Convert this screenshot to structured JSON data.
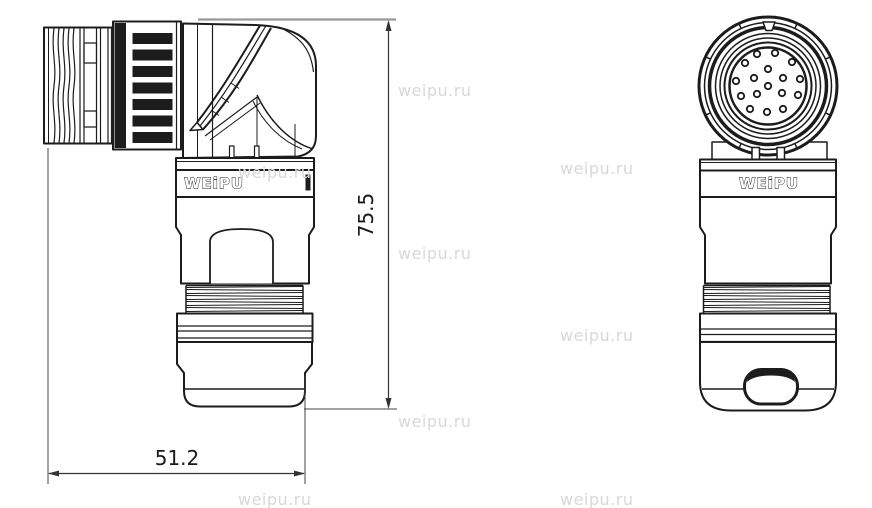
{
  "drawing": {
    "brand_logo": "WEiPU",
    "dimensions": {
      "height_mm": "75.5",
      "width_mm": "51.2"
    },
    "watermark": {
      "text": "weipu.ru",
      "color": "#d8d8d8"
    },
    "line_color": "#1c1c1c"
  },
  "front_view": {
    "pin_count": 17,
    "face_center": [
      768,
      86
    ],
    "pin_radius": 3.2,
    "pins": [
      [
        -11,
        -32
      ],
      [
        7,
        -33
      ],
      [
        -23,
        -23
      ],
      [
        24,
        -24
      ],
      [
        0,
        -17
      ],
      [
        -14,
        -8
      ],
      [
        15,
        -8
      ],
      [
        -32,
        -5
      ],
      [
        32,
        -7
      ],
      [
        0,
        0
      ],
      [
        -11,
        8
      ],
      [
        14,
        7
      ],
      [
        -27,
        10
      ],
      [
        30,
        9
      ],
      [
        -18,
        23
      ],
      [
        -1,
        26
      ],
      [
        15,
        23
      ]
    ]
  }
}
